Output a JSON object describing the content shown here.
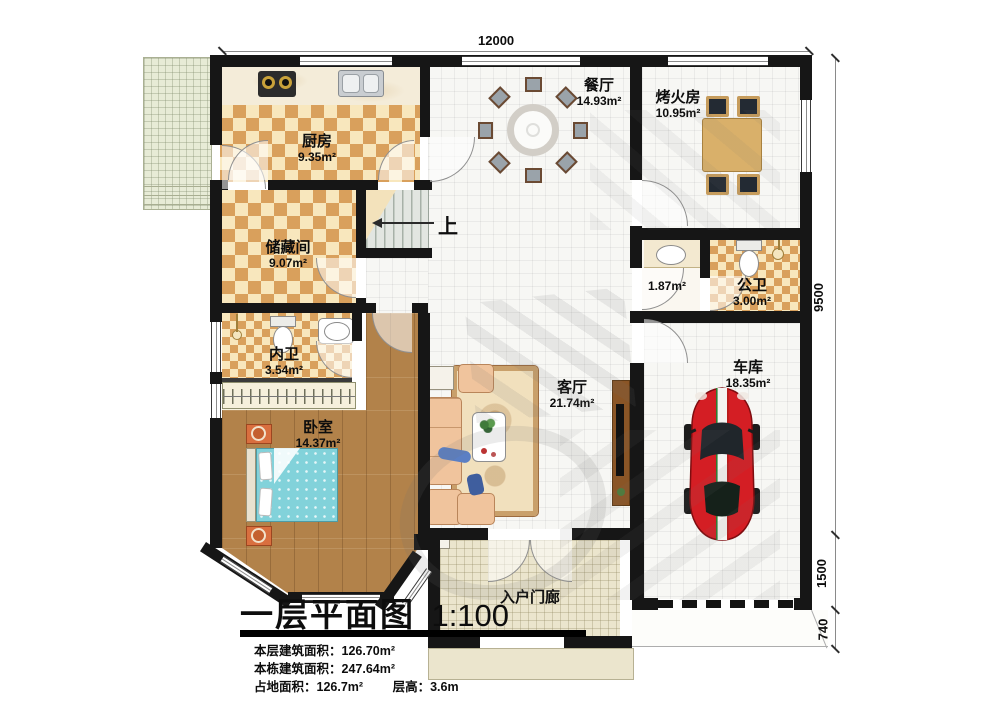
{
  "title_block": {
    "title": "一层平面图",
    "scale": "1:100",
    "stats": [
      {
        "label": "本层建筑面积：",
        "value": "126.70m²"
      },
      {
        "label": "本栋建筑面积：",
        "value": "247.64m²"
      },
      {
        "label": "占地面积：",
        "value": "126.7m²"
      },
      {
        "label": "层高：",
        "value": "3.6m"
      }
    ]
  },
  "dimensions": {
    "top_width": "12000",
    "house_depth": "9500",
    "porch_depth": "1500",
    "steps_depth": "740"
  },
  "rooms": {
    "kitchen": {
      "name": "厨房",
      "area": "9.35m²"
    },
    "dining": {
      "name": "餐厅",
      "area": "14.93m²"
    },
    "fire_room": {
      "name": "烤火房",
      "area": "10.95m²"
    },
    "storage": {
      "name": "储藏间",
      "area": "9.07m²"
    },
    "hallway": {
      "area": "1.87m²"
    },
    "public_bath": {
      "name": "公卫",
      "area": "3.00m²"
    },
    "private_bath": {
      "name": "内卫",
      "area": "3.54m²"
    },
    "bedroom": {
      "name": "卧室",
      "area": "14.37m²"
    },
    "living": {
      "name": "客厅",
      "area": "21.74m²"
    },
    "garage": {
      "name": "车库",
      "area": "18.35m²"
    },
    "porch": {
      "name": "入户门廊"
    }
  },
  "stairs": {
    "up_label": "上"
  },
  "colors": {
    "wall": "#161616",
    "checker_dark": "#d9a05c",
    "checker_light": "#f8e7bd",
    "wood": "#b2824a",
    "car_red": "#d41e24",
    "bed_teal": "#82d2da",
    "sofa_peach": "#f0c49d",
    "porch_tile": "#ebe5cd",
    "patio_green": "#e7ebd6"
  }
}
